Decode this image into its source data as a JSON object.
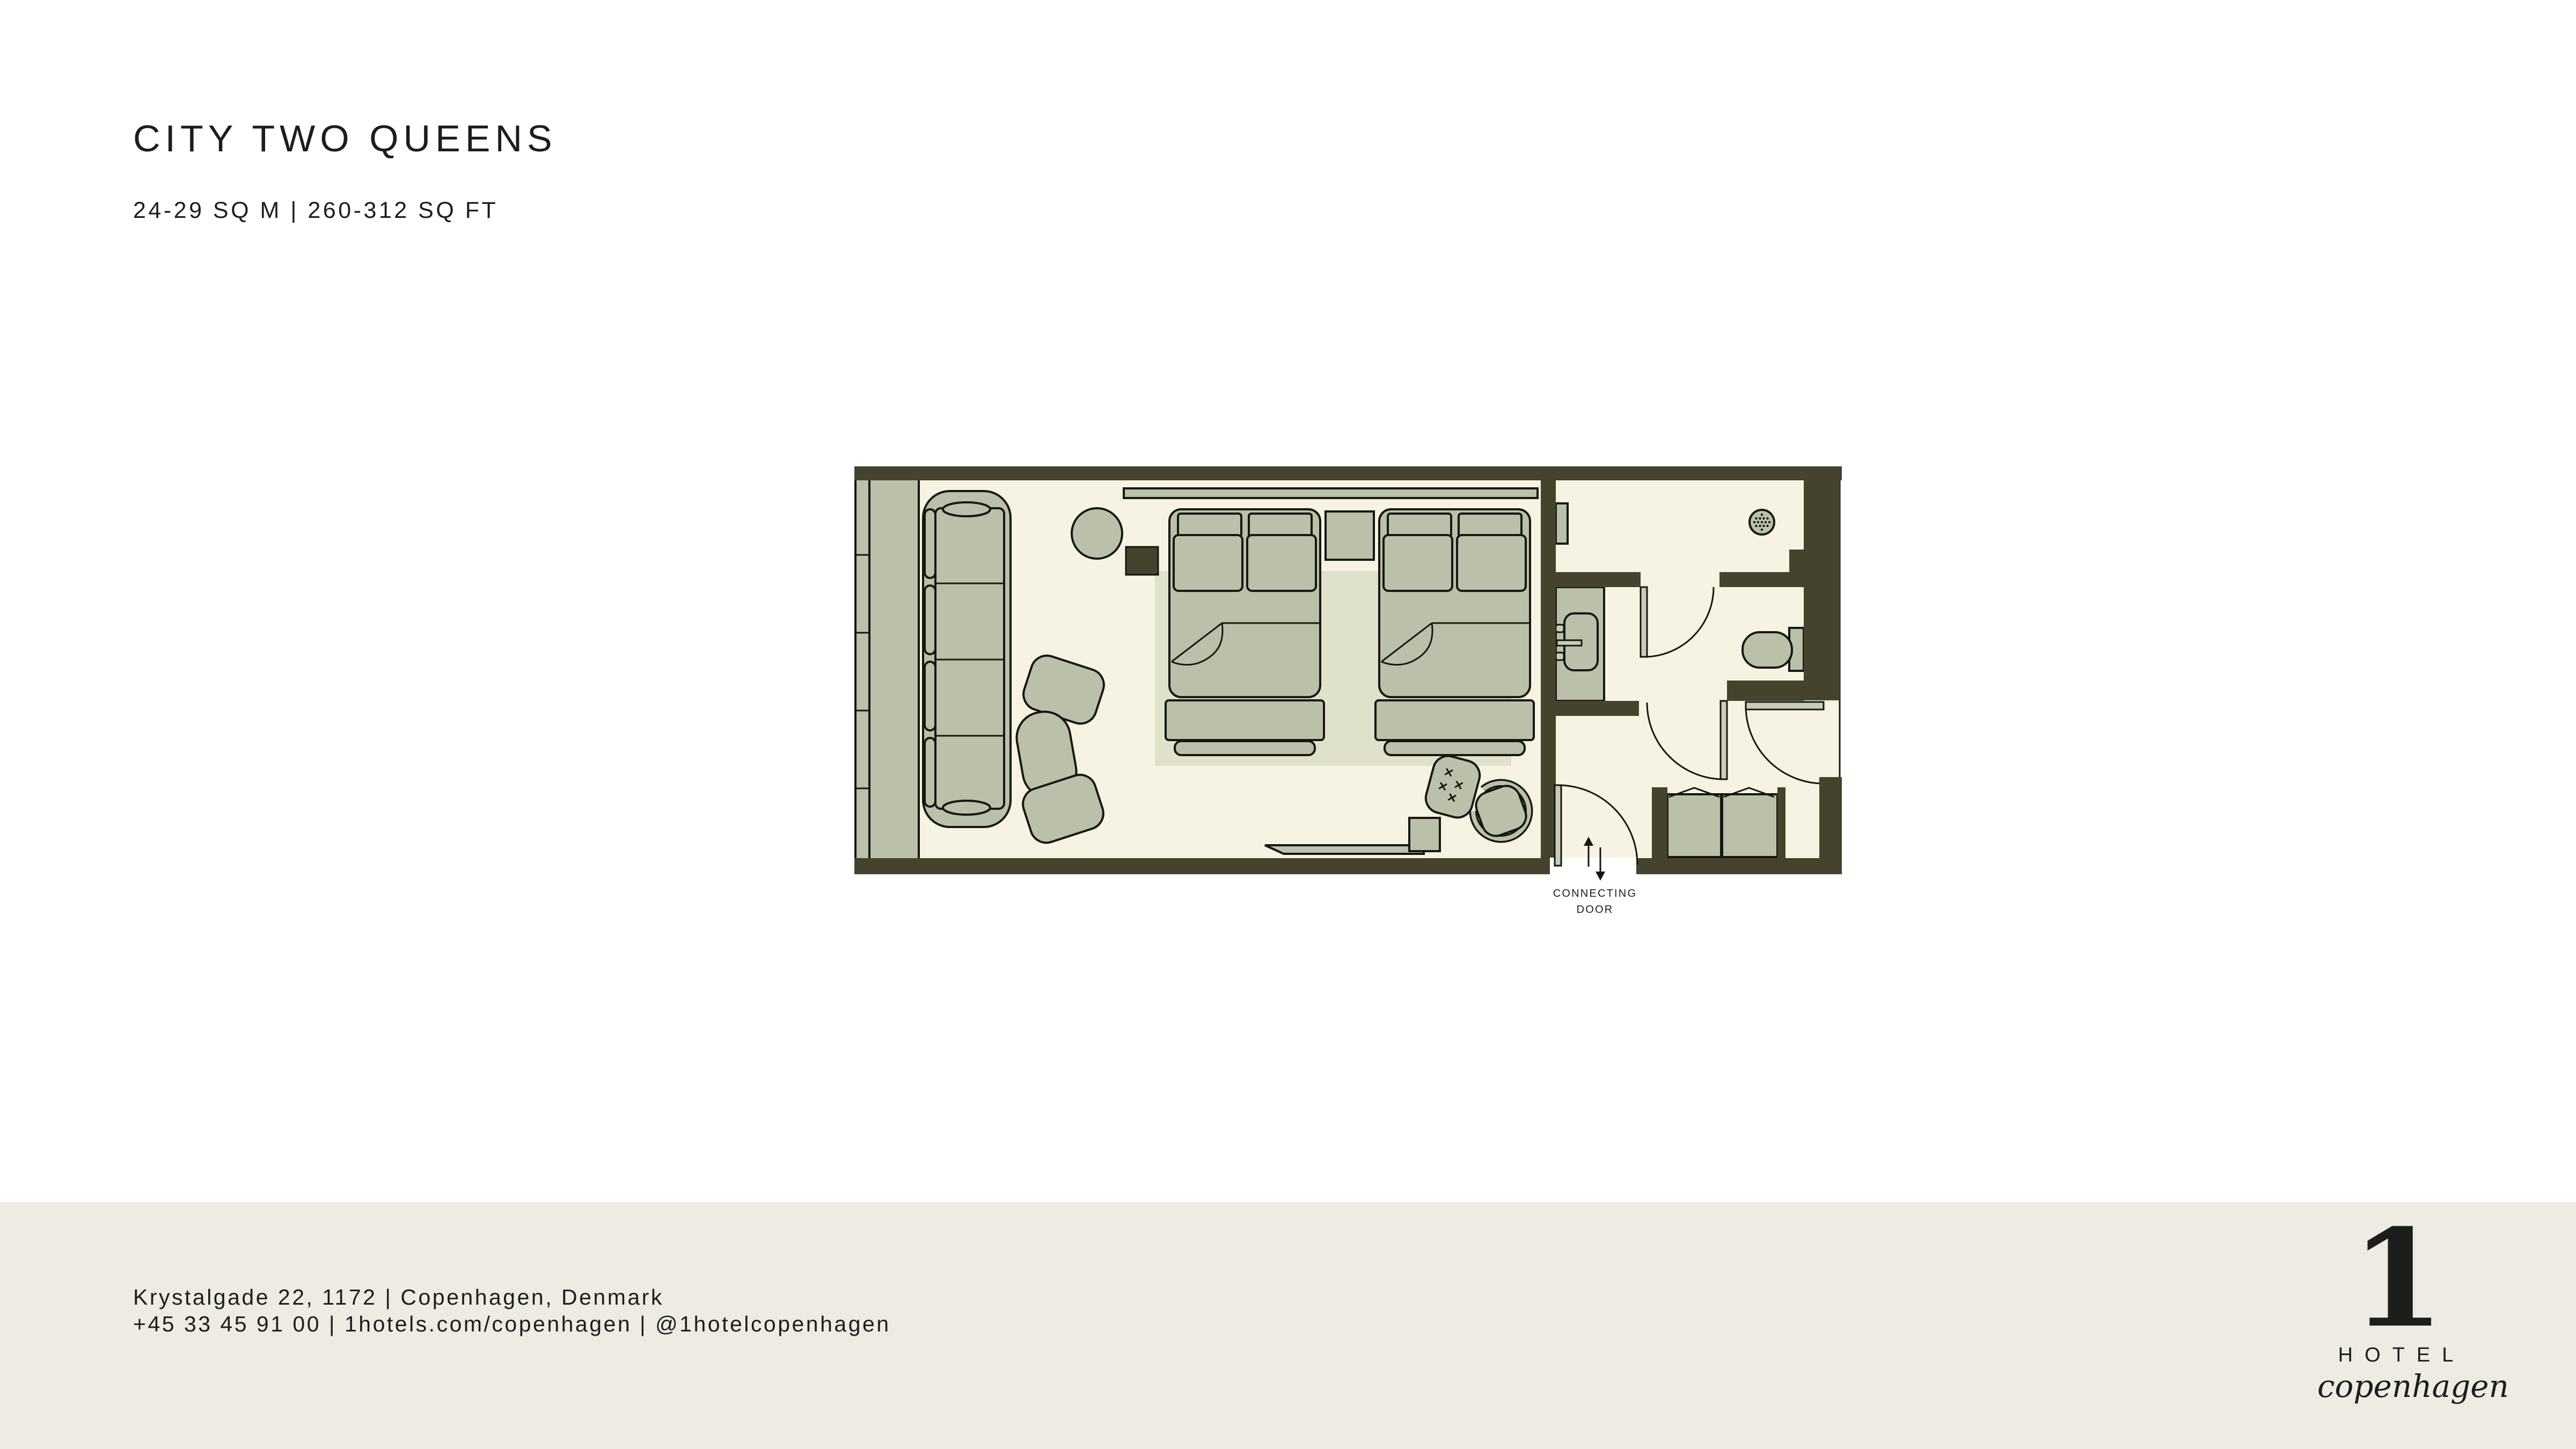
{
  "colors": {
    "page_bg": "#ffffff",
    "footer_bg": "#edebe2",
    "text": "#1d1d1b",
    "wall": "#45432e",
    "floor": "#f6f3e2",
    "furniture": "#bac0a9",
    "furniture_light": "#c9cdb7",
    "rug": "#dfe1cb",
    "outline": "#17170f"
  },
  "header": {
    "title": "CITY TWO QUEENS",
    "subtitle": "24-29 SQ M | 260-312 SQ FT"
  },
  "floor_plan": {
    "connecting_door_label_line1": "CONNECTING",
    "connecting_door_label_line2": "DOOR"
  },
  "footer": {
    "address": "Krystalgade 22, 1172 | Copenhagen, Denmark",
    "contact": "+45 33 45 91 00 | 1hotels.com/copenhagen | @1hotelcopenhagen",
    "logo": {
      "numeral": "1",
      "word": "HOTEL",
      "script": "copenhagen"
    }
  }
}
